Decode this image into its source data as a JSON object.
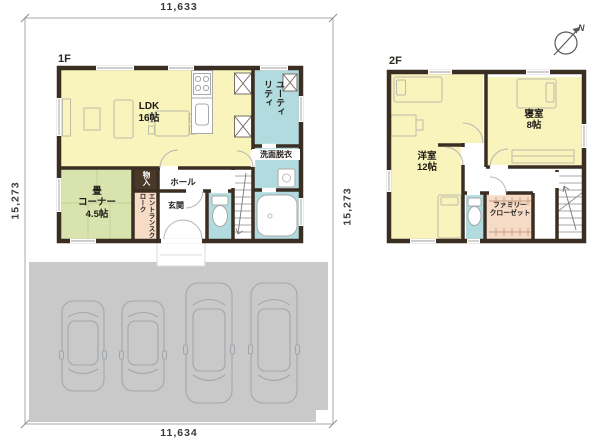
{
  "dimensions": {
    "top": "11,633",
    "bottom": "11,634",
    "left": "15,273",
    "right": "15,273"
  },
  "floor1": {
    "label": "1F",
    "ldk": "LDK\n16帖",
    "utility": "ユーティリティ",
    "washroom": "洗面脱衣",
    "tatami_corner": "畳\nコーナー\n4.5帖",
    "storage": "物入",
    "hall": "ホール",
    "entrance": "玄関",
    "entrance_cloak": "エントランスクローク"
  },
  "floor2": {
    "label": "2F",
    "western_room": "洋室\n12帖",
    "bedroom": "寝室\n8帖",
    "family_closet": "ファミリー\nクローゼット"
  },
  "compass": {
    "north_label": "N"
  },
  "parking": {
    "car_count": 4
  },
  "colors": {
    "wall": "#3a2e22",
    "room_yellow": "#f8f4bb",
    "room_green": "#d8e3ad",
    "room_blue": "#b2dbe0",
    "room_peach": "#f6dcc7",
    "storage_dark": "#4a3928",
    "parking_gray": "#c9c9ca"
  }
}
